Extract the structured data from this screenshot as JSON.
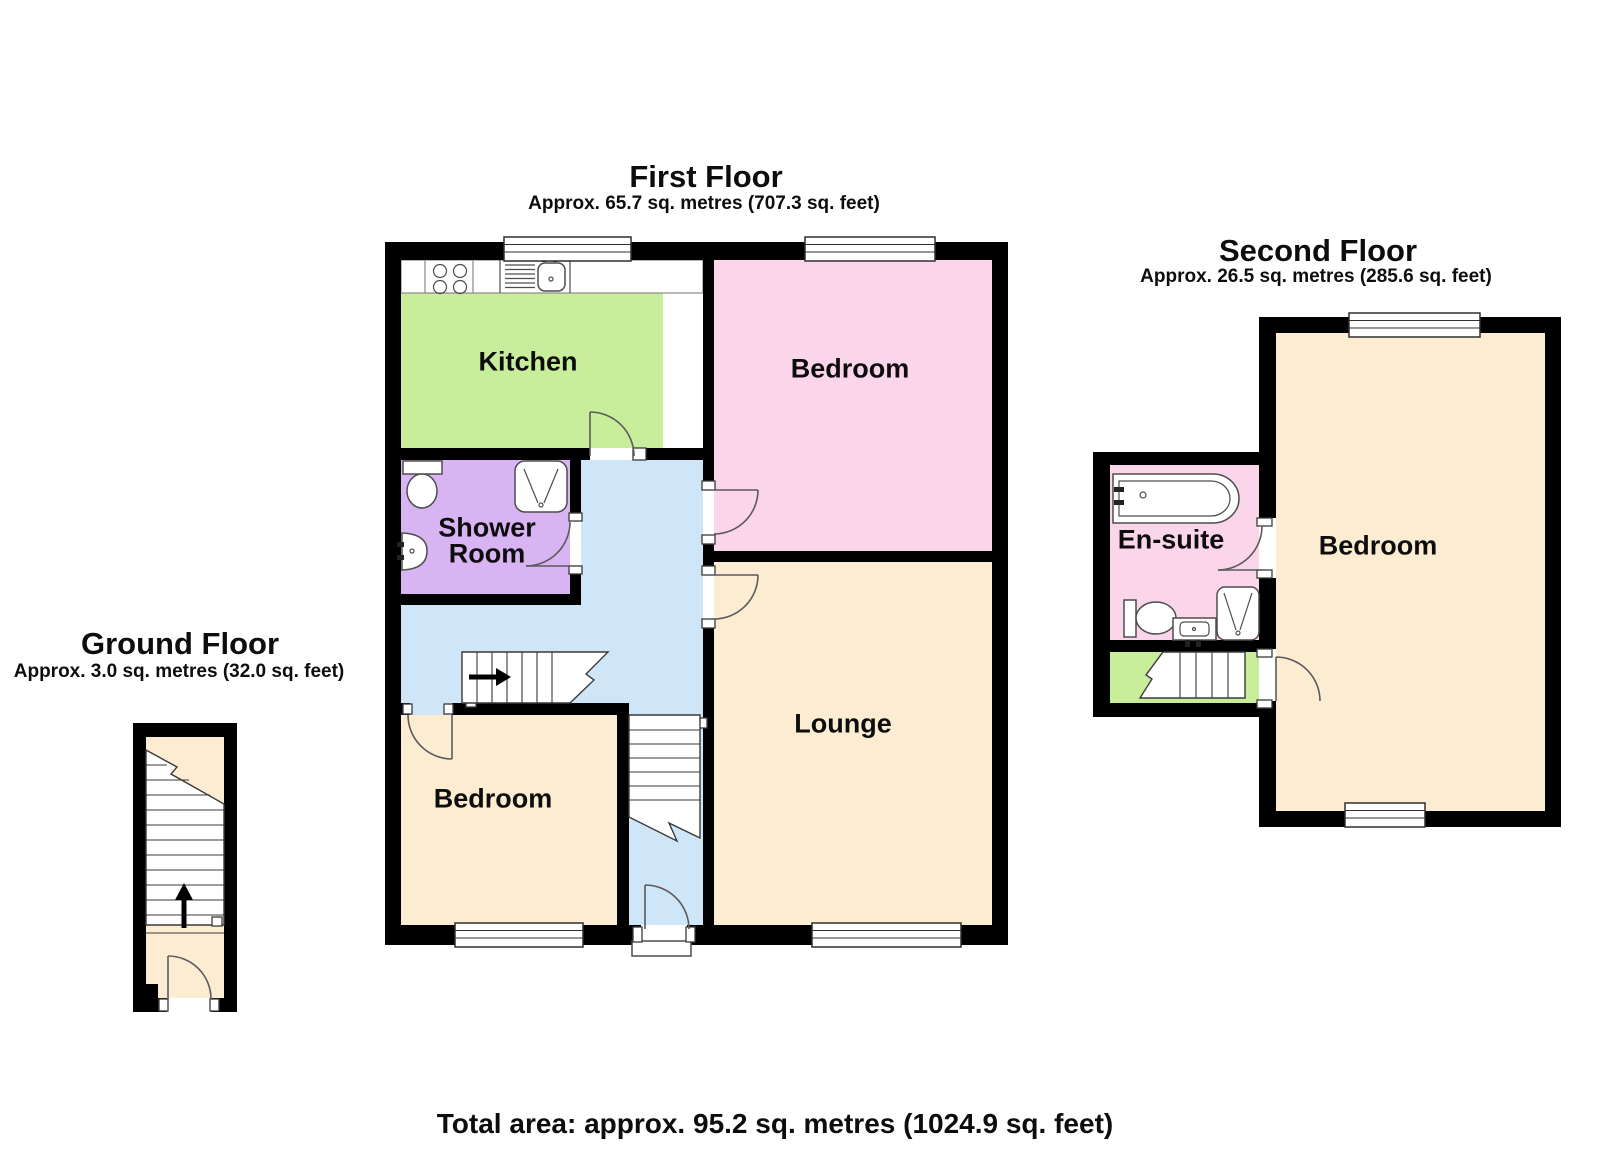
{
  "footer": {
    "total_area": "Total area: approx. 95.2 sq. metres (1024.9 sq. feet)"
  },
  "floors": {
    "ground": {
      "title": "Ground Floor",
      "subtitle": "Approx. 3.0 sq. metres (32.0 sq. feet)"
    },
    "first": {
      "title": "First Floor",
      "subtitle": "Approx. 65.7 sq. metres (707.3 sq. feet)",
      "rooms": {
        "kitchen": "Kitchen",
        "bedroom_front": "Bedroom",
        "shower_line1": "Shower",
        "shower_line2": "Room",
        "lounge": "Lounge",
        "bedroom_rear": "Bedroom"
      }
    },
    "second": {
      "title": "Second Floor",
      "subtitle": "Approx. 26.5 sq. metres (285.6 sq. feet)",
      "rooms": {
        "ensuite": "En-suite",
        "bedroom": "Bedroom"
      }
    }
  },
  "colors": {
    "kitchen_green": "#c8ee9b",
    "bedroom_pink": "#fbd5e9",
    "shower_lilac": "#d9b4f2",
    "hall_blue": "#cfe5f8",
    "room_cream": "#fcedd2",
    "wall_black": "#000000"
  }
}
